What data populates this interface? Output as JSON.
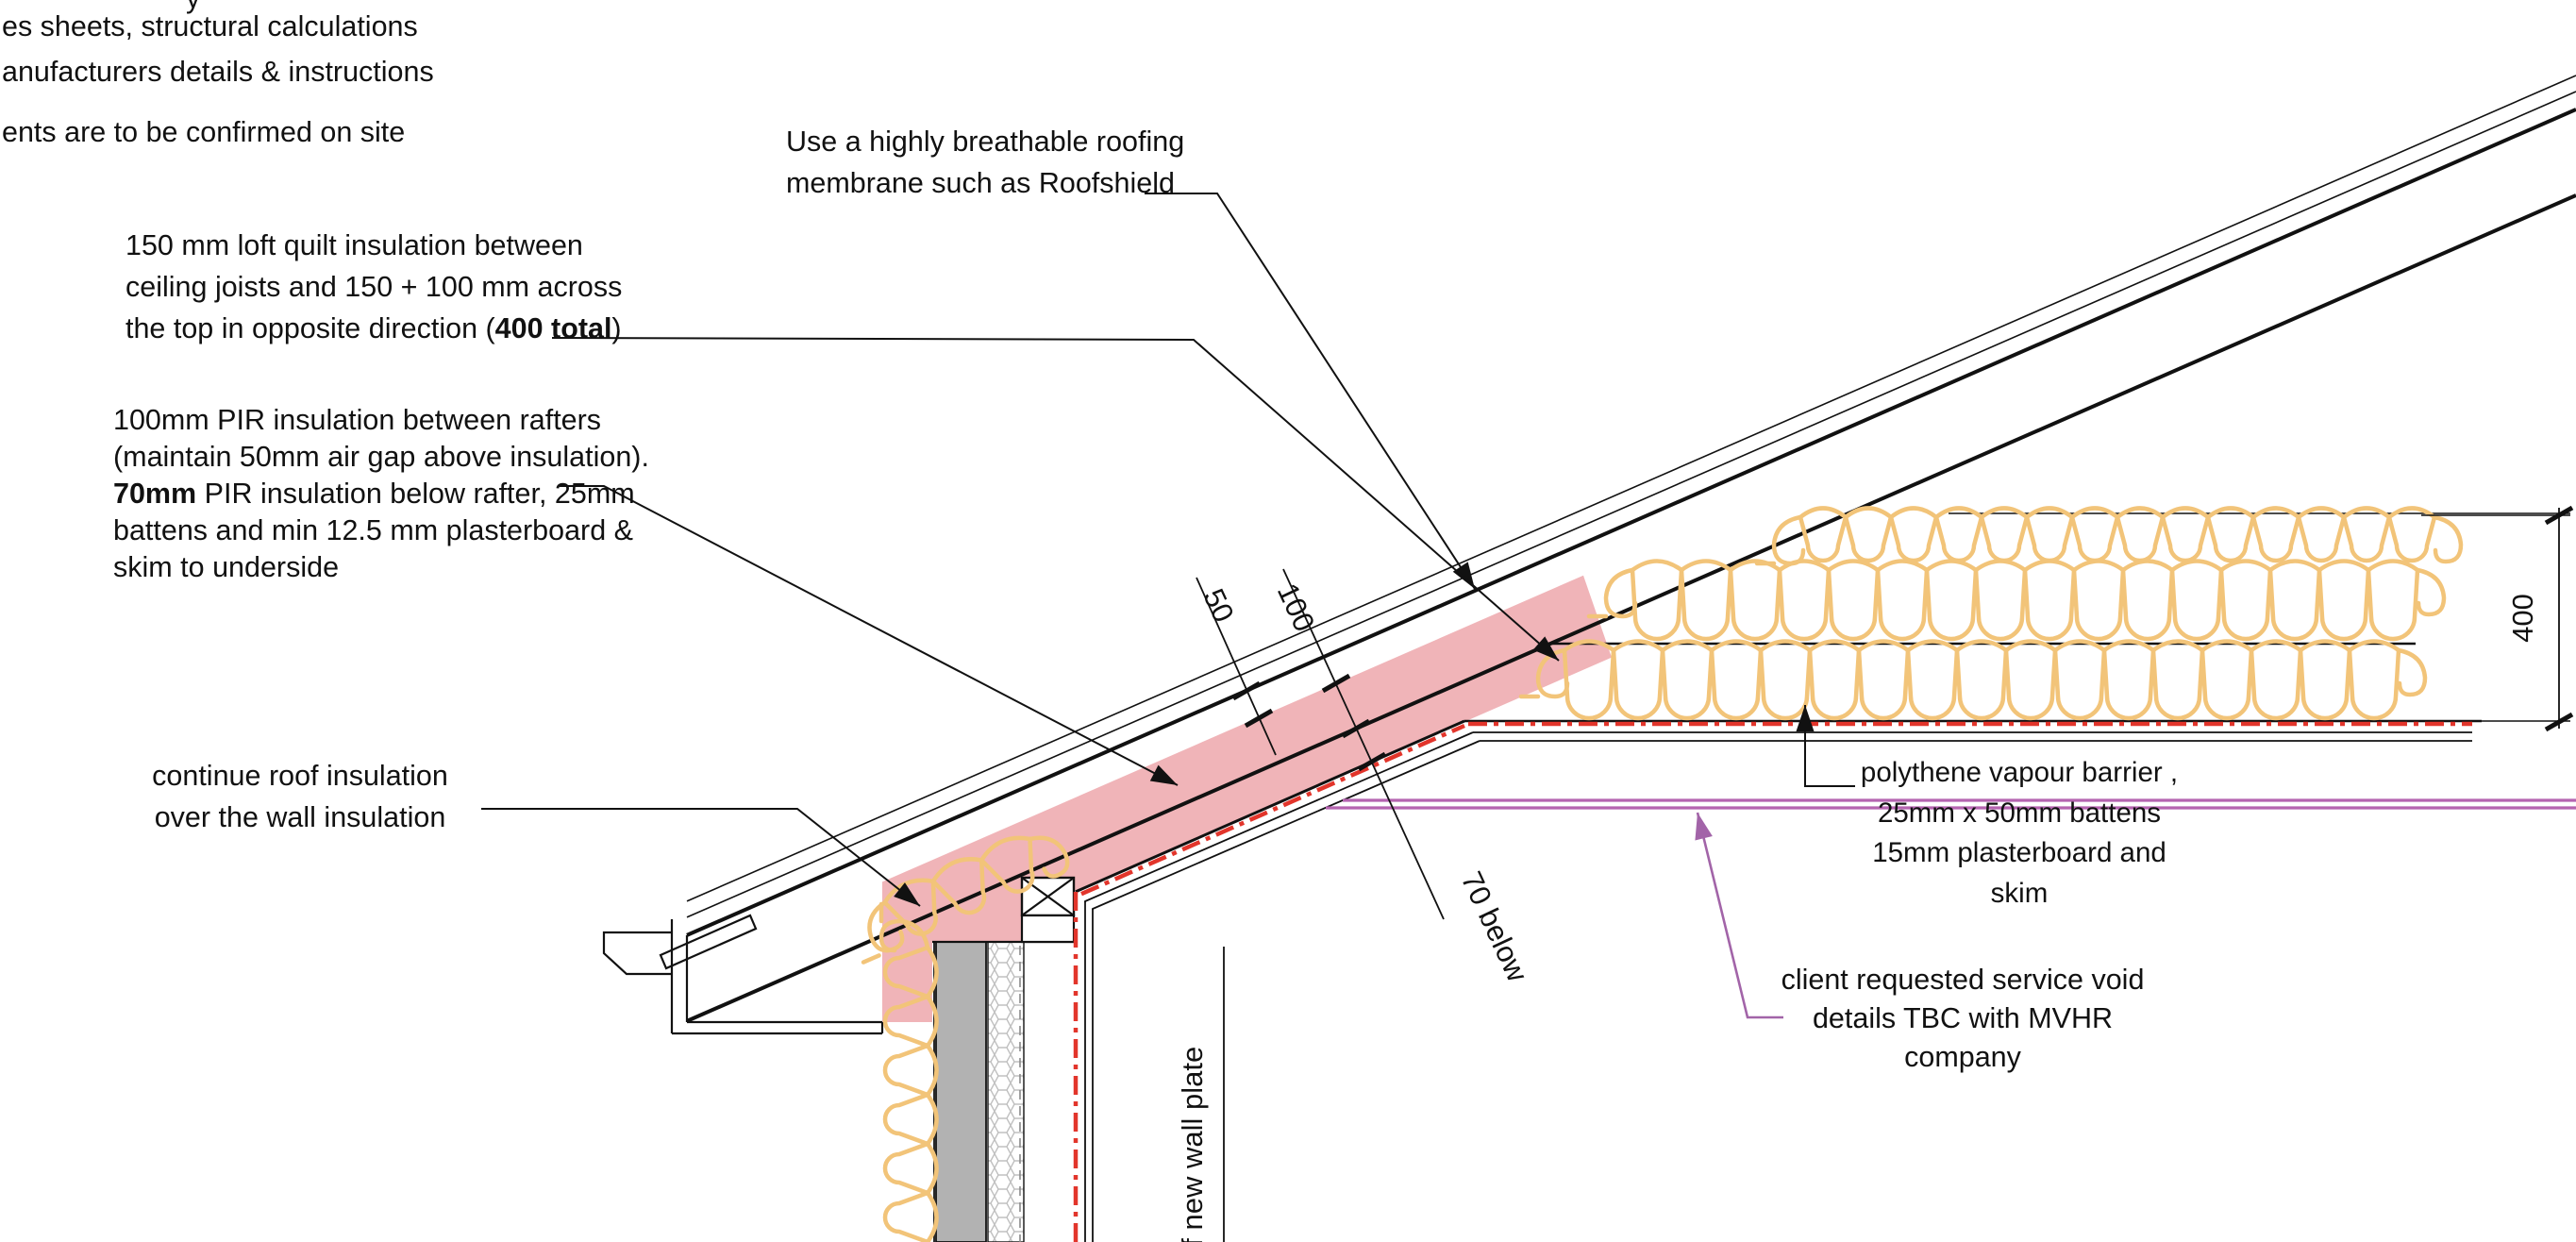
{
  "title": "roof eaves insulation construction detail",
  "notes_top_left": {
    "cut_glyph": "y",
    "line1": "es sheets, structural calculations",
    "line2": "anufacturers details & instructions",
    "line3": "ents are to be confirmed on site"
  },
  "annotations": {
    "membrane": {
      "line1": "Use a highly breathable roofing",
      "line2": "membrane such as Roofshield"
    },
    "quilt": {
      "line1": "150 mm loft quilt insulation between",
      "line2": "ceiling joists and 150 + 100 mm across",
      "line3_pre": "the top in opposite direction (",
      "line3_bold": "400 total",
      "line3_post": ")"
    },
    "pir": {
      "line1": "100mm PIR insulation between rafters",
      "line2": "(maintain 50mm air gap above insulation).",
      "line3_bold": "70mm",
      "line3_rest": " PIR insulation below rafter, 25mm",
      "line4": "battens and min 12.5 mm plasterboard &",
      "line5": "skim to underside"
    },
    "continue_ins": {
      "line1": "continue roof insulation",
      "line2": "over the wall insulation"
    },
    "vapour": {
      "line1": "polythene vapour barrier ,",
      "line2": "25mm x 50mm battens",
      "line3": "15mm plasterboard and skim"
    },
    "client": {
      "line1": "client requested service void",
      "line2": "details TBC with MVHR company"
    }
  },
  "dims": {
    "d50": "50",
    "d100": "100",
    "d70": "70 below",
    "d400": "400"
  },
  "wall_label": "of new wall plate",
  "colors": {
    "line": "#111111",
    "pink_insulation": "#F0B4B8",
    "quilt_loops": "#F2C479",
    "vcl_red": "#E2352B",
    "vapour_magenta": "#B564B0",
    "leader_purple": "#A264A8",
    "masonry_gray": "#B2B2B2",
    "hex_stroke": "#C0C0C0"
  }
}
